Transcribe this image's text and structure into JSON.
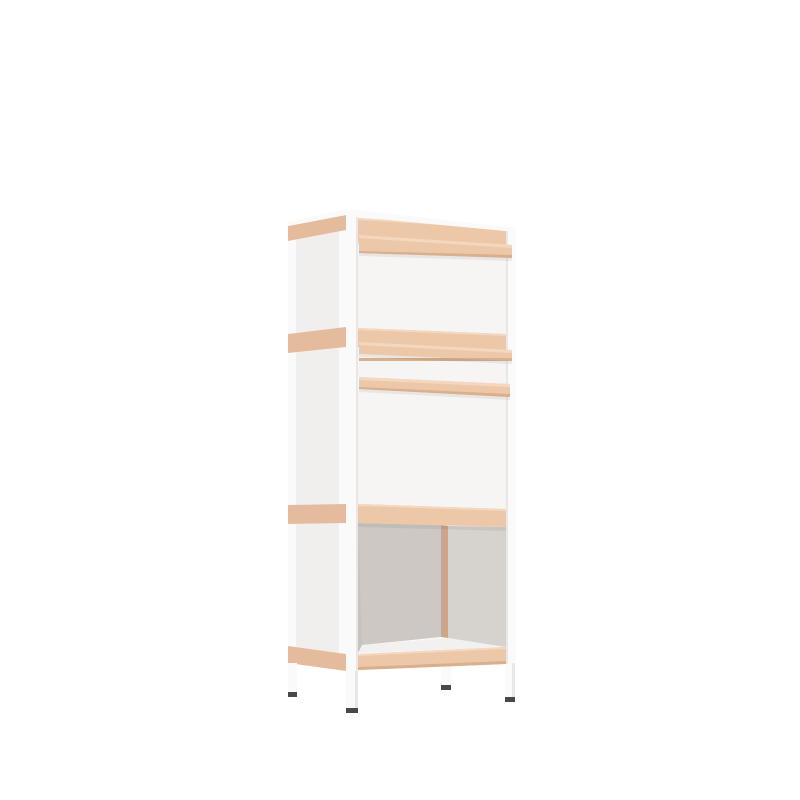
{
  "scene": {
    "object": "modular-storage-cabinet",
    "view": "three-quarter front-left product render",
    "background": "plain white"
  },
  "parts": [
    "top surface",
    "left side panel with wood rails",
    "upper front door panel",
    "front drawer with wood edge strips",
    "lower front door panel",
    "open bottom compartment",
    "wood base rail",
    "four white legs with dark feet"
  ],
  "colors": {
    "bg": "#ffffff",
    "frame": "#fafafa",
    "frameShade": "#e9e7e5",
    "frontPanel": "#f7f5f4",
    "sidePanel": "#f1efee",
    "woodFront": "#ecc8a9",
    "woodLight": "#f3d8bf",
    "woodDark": "#d9af8c",
    "woodSide": "#e4bc9d",
    "interiorBack": "#cdc8c4",
    "interiorRight": "#d6d2ce",
    "interiorLeft": "#c7c2be",
    "interiorWood": "#d0a585",
    "interiorFloor": "#f3f1ef",
    "topSurface": "#fbfaf9",
    "foot": "#4a4847",
    "shadow": "rgba(0,0,0,0.06)"
  }
}
